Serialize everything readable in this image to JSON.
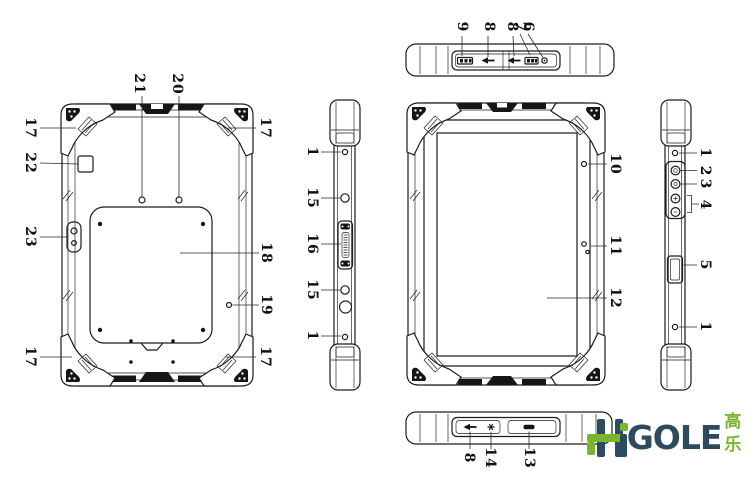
{
  "callouts": {
    "back": [
      "21",
      "20",
      "17",
      "22",
      "23",
      "17",
      "17",
      "18",
      "19",
      "17"
    ],
    "side_left": [
      "1",
      "15",
      "16",
      "15",
      "1"
    ],
    "front": [
      "10",
      "11",
      "12"
    ],
    "side_right": [
      "1",
      "2",
      "3",
      "4",
      "5",
      "1"
    ],
    "top": [
      "9",
      "8",
      "8",
      "7",
      "6"
    ],
    "bottom": [
      "8",
      "14",
      "13"
    ]
  },
  "logo": {
    "gole": "GOLE",
    "cn": "高乐",
    "dark_color": "#2d4b5e",
    "green_color": "#7ab52e"
  },
  "colors": {
    "line": "#1c1c1c",
    "background": "#ffffff"
  }
}
